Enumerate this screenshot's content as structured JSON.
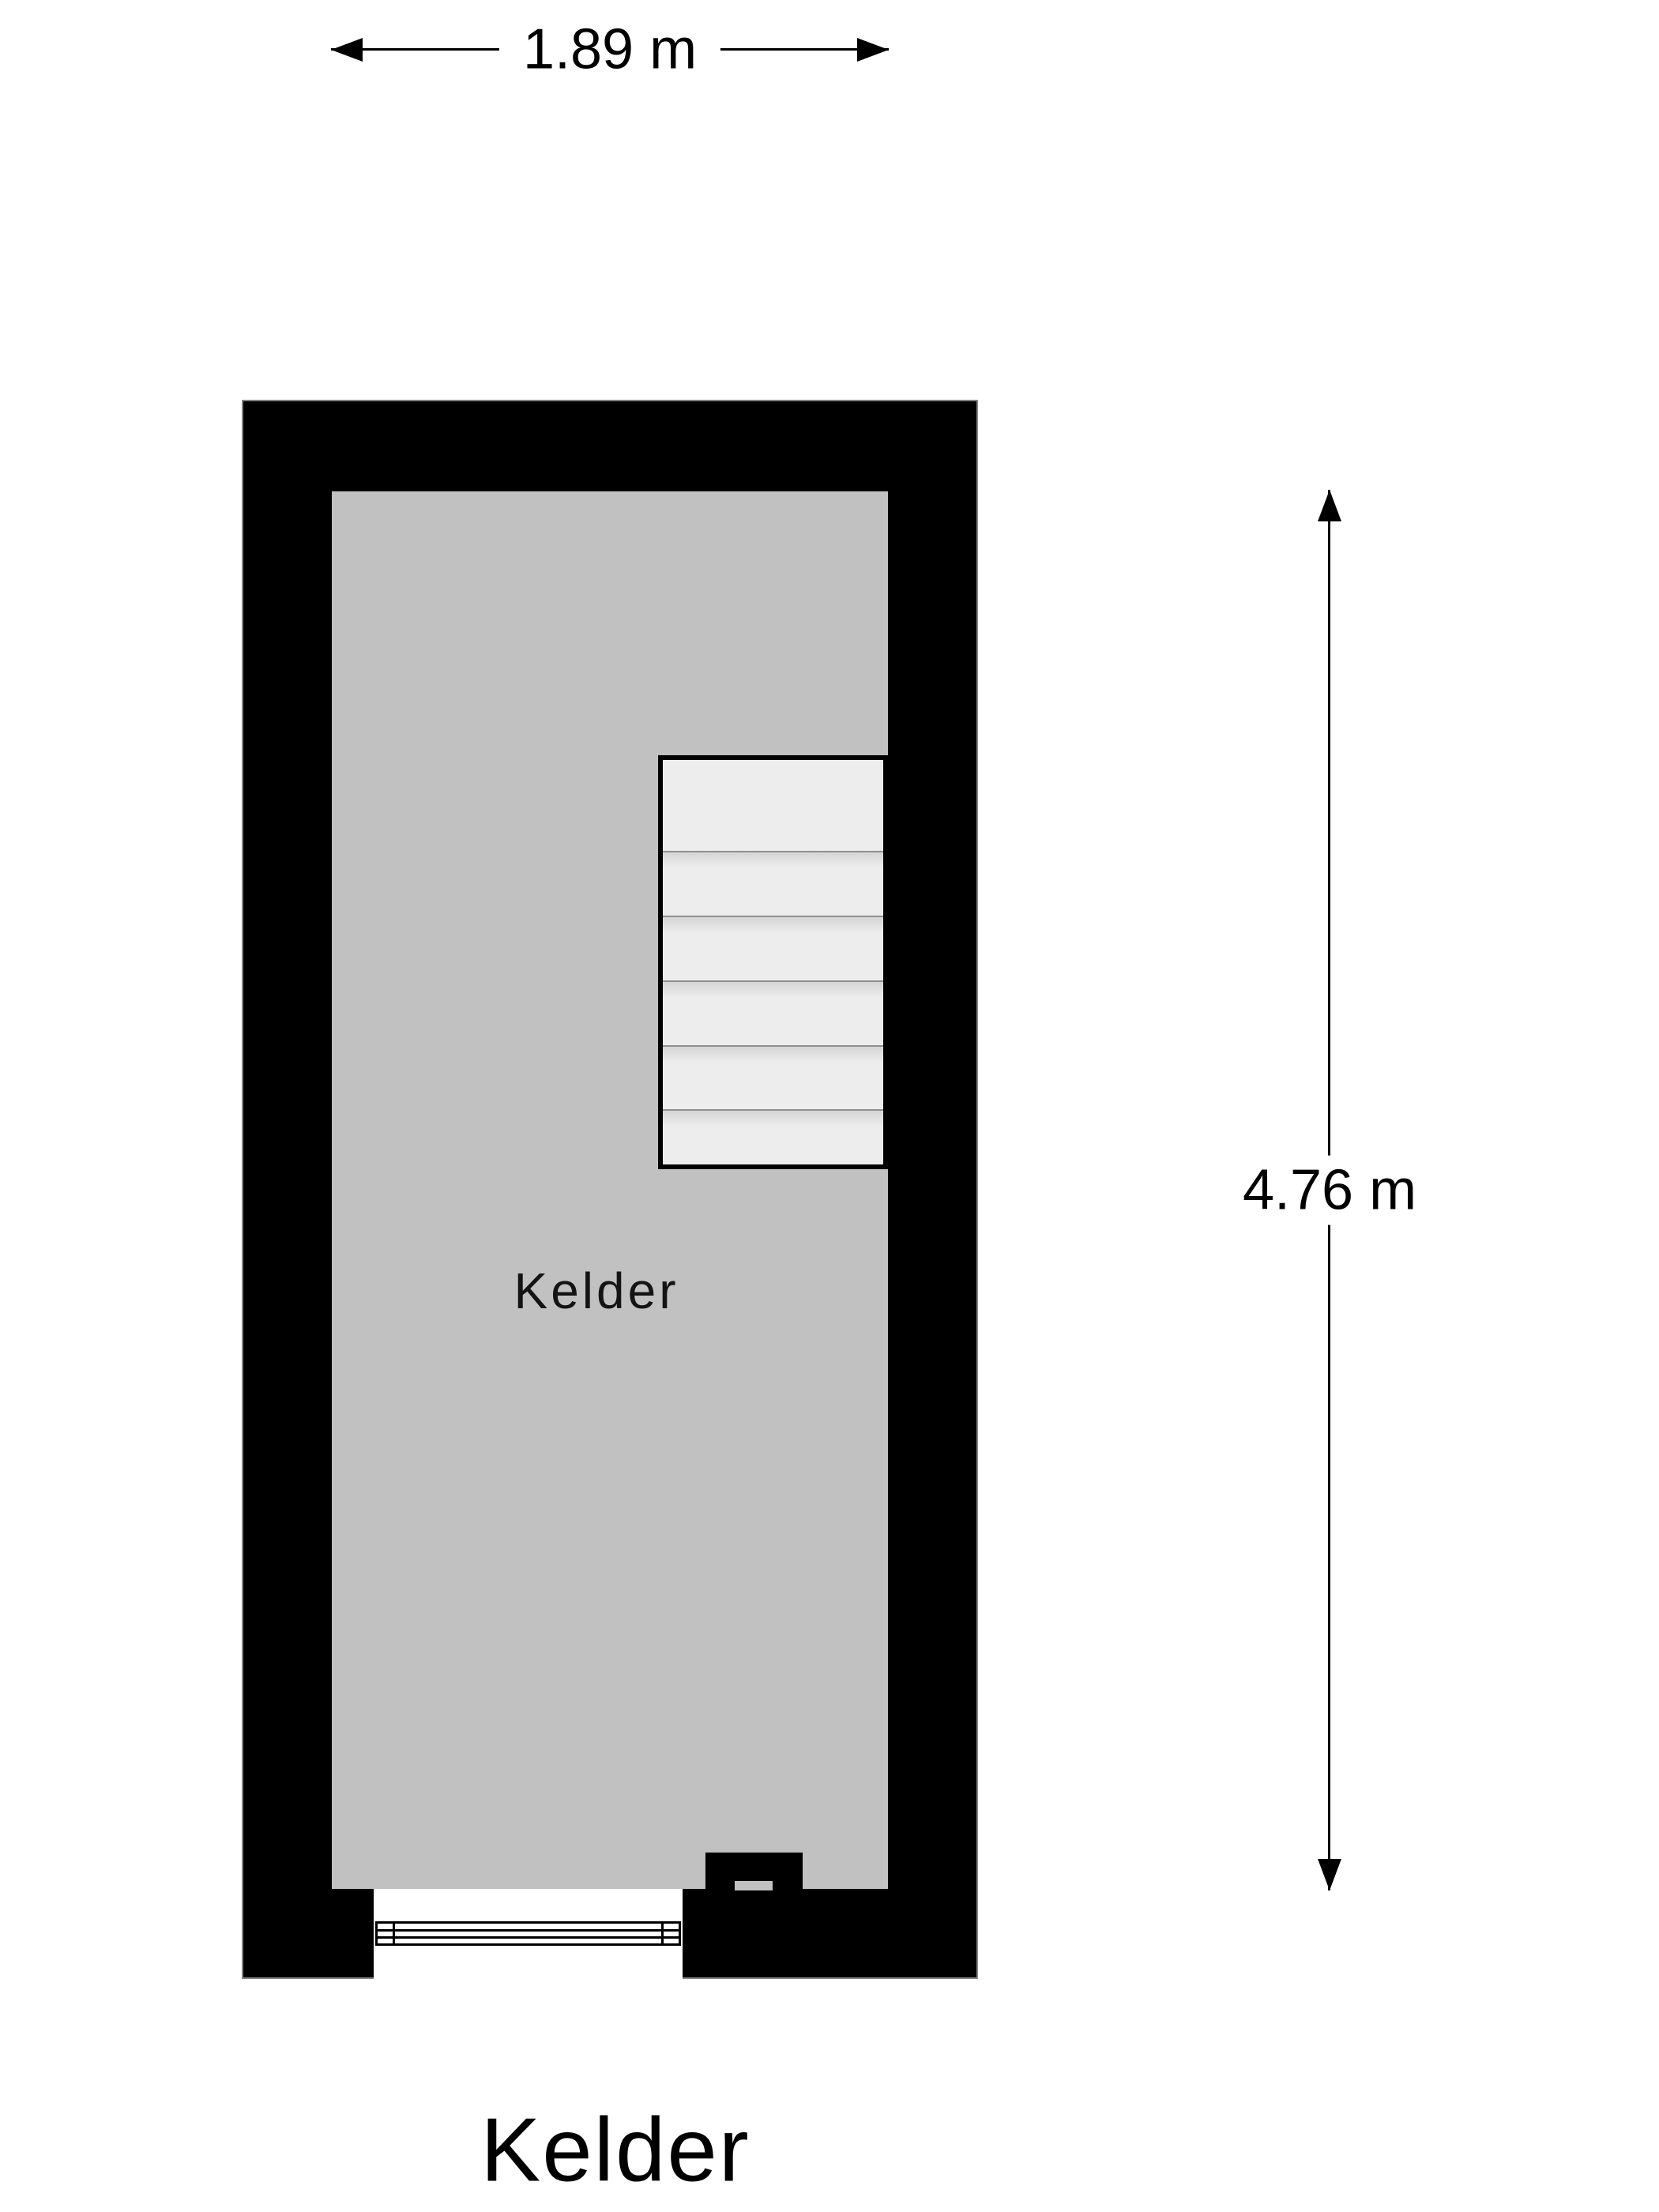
{
  "floorplan": {
    "title": "Kelder",
    "room": {
      "label": "Kelder"
    },
    "dimensions": {
      "width": "1.89 m",
      "height": "4.76 m"
    },
    "stairs": {
      "flights": 1,
      "visible_treads": 6
    },
    "colors": {
      "wall": "#000000",
      "floor": "#c1c1c1",
      "stair_fill": "#ededed",
      "stair_divider": "#8f8f8f",
      "background": "#ffffff",
      "dimension_line": "#000000",
      "text": "#000000"
    }
  }
}
